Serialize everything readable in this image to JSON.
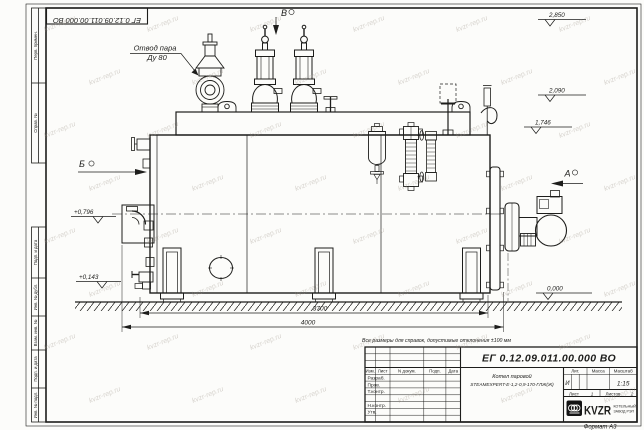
{
  "watermark": "kvzr-rep.ru",
  "corner_stamp": "ЕГ 0.12.09.011.00.000  ВО",
  "note": "Все размеры для справок, допустимые отклонения ±100 мм",
  "format": "Формат А3",
  "margin": [
    "Перв. примен.",
    "Справ. №",
    "Подп. и дата",
    "Инв. № дубл.",
    "Взам. инв. №",
    "Подп. и дата",
    "Инв. № подл."
  ],
  "ann": {
    "steam1": "Отвод пара",
    "steam2": "Ду 80",
    "vA": "А",
    "vB": "Б",
    "vV": "В",
    "e1": "2,850",
    "e2": "2,090",
    "e3": "1,746",
    "e4": "+0,796",
    "e5": "+0,143",
    "e6": "0,000",
    "d1": "3700",
    "d2": "4000"
  },
  "tb": {
    "doc": "ЕГ 0.12.09.011.00.000  ВО",
    "name1": "Котел паровой",
    "name2": "STEAMEXPERT-Е-1,2-0,9-170-ГЛЖ(Ж)",
    "h_izm": "Изм.",
    "h_list": "Лист",
    "h_ndoc": "N докум.",
    "h_podp": "Подп.",
    "h_data": "Дата",
    "r1": "Разраб.",
    "r2": "Пров.",
    "r3": "Т.контр.",
    "r4": "Н.контр.",
    "r5": "Утв.",
    "lit": "Лит.",
    "mass": "Масса",
    "scale": "Масштаб",
    "lit_v": "И",
    "scale_v": "1:15",
    "sheet_l": "Лист",
    "sheet_v": "1",
    "sheets_l": "Листов",
    "sheets_v": "2",
    "logo": "KVZR",
    "logo1": "КОТЕЛЬНЫЙ",
    "logo2": "ЗАВОД РЭП"
  }
}
